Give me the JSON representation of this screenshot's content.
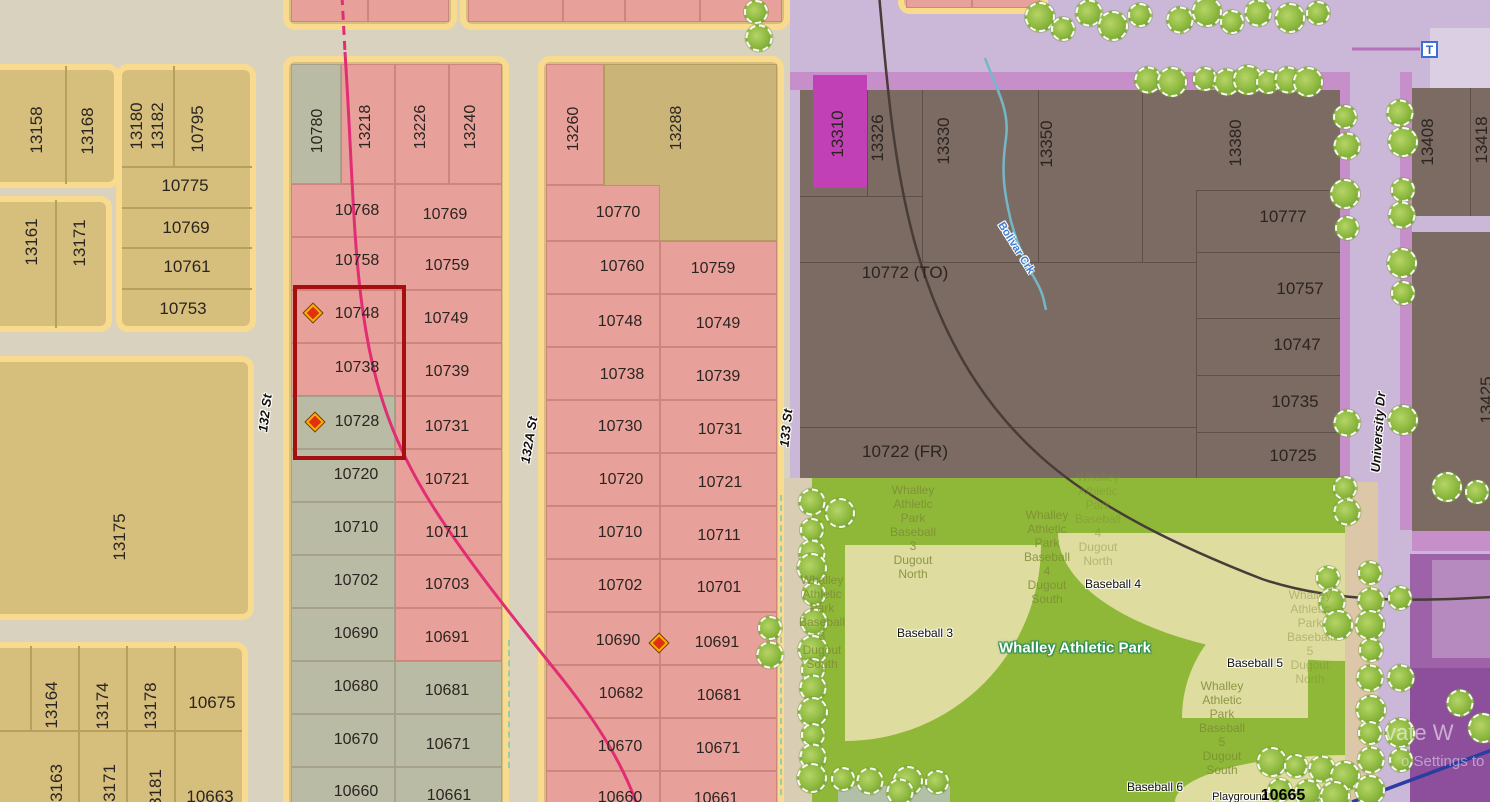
{
  "canvas": {
    "width": 1490,
    "height": 802
  },
  "colors": {
    "selection_red": "#a50f0f",
    "marker_red": "#e03010",
    "marker_ring": "#ffb300",
    "pink_parcel": "#e7a19a",
    "sage_parcel": "#b9bba5",
    "yellow_parcel": "#d6bf7d",
    "yellow_halo": "#f9db8f",
    "khaki_parcel": "#cab477",
    "brown_parcel": "#7b6b63",
    "magenta_parcel": "#c240b5",
    "lavender": "#cbb8d8",
    "purple_road": "#c78fc9",
    "park_green": "#90b838",
    "field_tan": "#dedc9f",
    "magenta_line": "#e12d73",
    "creek_blue": "#74b7c8",
    "dark_line": "#473c37",
    "navy_line": "#2c3da0"
  },
  "streets": [
    {
      "name": "132 St",
      "x": 265,
      "y": 413,
      "rot": -83
    },
    {
      "name": "132A St",
      "x": 529,
      "y": 440,
      "rot": -80
    },
    {
      "name": "133 St",
      "x": 786,
      "y": 428,
      "rot": -84
    },
    {
      "name": "University Dr",
      "x": 1378,
      "y": 432,
      "rot": -86
    }
  ],
  "creek": {
    "name": "Bolivar Crk",
    "x": 1016,
    "y": 248,
    "rot": 58
  },
  "transit": {
    "label": "T",
    "x": 1421,
    "y": 41
  },
  "park": {
    "name": "Whalley Athletic Park",
    "name_x": 1075,
    "name_y": 648,
    "fields": [
      {
        "label": "Baseball 3",
        "x": 925,
        "y": 633
      },
      {
        "label": "Baseball 4",
        "x": 1113,
        "y": 584
      },
      {
        "label": "Baseball 5",
        "x": 1255,
        "y": 663
      },
      {
        "label": "Baseball 6",
        "x": 1155,
        "y": 787
      }
    ],
    "dugout_labels": [
      {
        "lines": [
          "Whalley",
          "Athletic",
          "Park",
          "Baseball",
          "3",
          "Dugout",
          "North"
        ],
        "x": 913,
        "y": 532,
        "faded": false
      },
      {
        "lines": [
          "Whalley",
          "Athletic",
          "Park",
          "Baseball",
          "3",
          "Dugout",
          "South"
        ],
        "x": 822,
        "y": 622,
        "faded": false
      },
      {
        "lines": [
          "Whalley",
          "Athletic",
          "Park",
          "Baseball",
          "4",
          "Dugout",
          "South"
        ],
        "x": 1047,
        "y": 557,
        "faded": false
      },
      {
        "lines": [
          "Whalley",
          "Athletic",
          "Park",
          "Baseball",
          "4",
          "Dugout",
          "North"
        ],
        "x": 1098,
        "y": 519,
        "faded": true
      },
      {
        "lines": [
          "Whalley",
          "Athletic",
          "Park",
          "Baseball",
          "5",
          "Dugout",
          "North"
        ],
        "x": 1310,
        "y": 637,
        "faded": true
      },
      {
        "lines": [
          "Whalley",
          "Athletic",
          "Park",
          "Baseball",
          "5",
          "Dugout",
          "South"
        ],
        "x": 1222,
        "y": 728,
        "faded": false
      }
    ],
    "playground": {
      "label": "Playground",
      "x": 1240,
      "y": 797
    },
    "lot": {
      "label": "10665",
      "x": 1283,
      "y": 796
    }
  },
  "watermark": {
    "line1": "vate W",
    "line2": "o Settings to"
  },
  "selection": {
    "parcels": [
      "10748",
      "10738",
      "10728"
    ],
    "rect": {
      "x": 293,
      "y": 285,
      "w": 105,
      "h": 167
    }
  },
  "markers": [
    {
      "x": 313,
      "y": 313
    },
    {
      "x": 315,
      "y": 422
    },
    {
      "x": 659,
      "y": 643
    }
  ],
  "parcel_labels": [
    {
      "t": "13158",
      "x": 37,
      "y": 130,
      "v": 1,
      "b": 1
    },
    {
      "t": "13168",
      "x": 88,
      "y": 131,
      "v": 1,
      "b": 1
    },
    {
      "t": "13180",
      "x": 137,
      "y": 126,
      "v": 1,
      "b": 1
    },
    {
      "t": "13182",
      "x": 158,
      "y": 126,
      "v": 1,
      "b": 1
    },
    {
      "t": "10795",
      "x": 198,
      "y": 129,
      "v": 1,
      "b": 1
    },
    {
      "t": "10775",
      "x": 185,
      "y": 186,
      "b": 1
    },
    {
      "t": "10769",
      "x": 186,
      "y": 228,
      "b": 1
    },
    {
      "t": "10761",
      "x": 187,
      "y": 267,
      "b": 1
    },
    {
      "t": "10753",
      "x": 183,
      "y": 309,
      "b": 1
    },
    {
      "t": "13161",
      "x": 32,
      "y": 242,
      "v": 1,
      "b": 1
    },
    {
      "t": "13171",
      "x": 80,
      "y": 243,
      "v": 1,
      "b": 1
    },
    {
      "t": "13175",
      "x": 120,
      "y": 537,
      "v": 1,
      "b": 1
    },
    {
      "t": "13164",
      "x": 52,
      "y": 705,
      "v": 1,
      "b": 1
    },
    {
      "t": "13174",
      "x": 103,
      "y": 706,
      "v": 1,
      "b": 1
    },
    {
      "t": "13178",
      "x": 151,
      "y": 706,
      "v": 1,
      "b": 1
    },
    {
      "t": "10675",
      "x": 212,
      "y": 703,
      "b": 1
    },
    {
      "t": "3163",
      "x": 57,
      "y": 783,
      "v": 1,
      "b": 1
    },
    {
      "t": "3171",
      "x": 110,
      "y": 783,
      "v": 1,
      "b": 1
    },
    {
      "t": "3181",
      "x": 156,
      "y": 788,
      "v": 1,
      "b": 1
    },
    {
      "t": "10663",
      "x": 210,
      "y": 797,
      "b": 1
    },
    {
      "t": "10780",
      "x": 318,
      "y": 131,
      "v": 1
    },
    {
      "t": "13218",
      "x": 366,
      "y": 127,
      "v": 1
    },
    {
      "t": "13226",
      "x": 421,
      "y": 127,
      "v": 1
    },
    {
      "t": "13240",
      "x": 471,
      "y": 127,
      "v": 1
    },
    {
      "t": "10768",
      "x": 357,
      "y": 211
    },
    {
      "t": "10769",
      "x": 445,
      "y": 215
    },
    {
      "t": "10758",
      "x": 357,
      "y": 261
    },
    {
      "t": "10759",
      "x": 447,
      "y": 266
    },
    {
      "t": "10748",
      "x": 357,
      "y": 314
    },
    {
      "t": "10749",
      "x": 446,
      "y": 319
    },
    {
      "t": "10738",
      "x": 357,
      "y": 368
    },
    {
      "t": "10739",
      "x": 447,
      "y": 372
    },
    {
      "t": "10728",
      "x": 357,
      "y": 422
    },
    {
      "t": "10731",
      "x": 447,
      "y": 427
    },
    {
      "t": "10720",
      "x": 356,
      "y": 475
    },
    {
      "t": "10721",
      "x": 447,
      "y": 480
    },
    {
      "t": "10710",
      "x": 356,
      "y": 528
    },
    {
      "t": "10711",
      "x": 447,
      "y": 533
    },
    {
      "t": "10702",
      "x": 356,
      "y": 581
    },
    {
      "t": "10703",
      "x": 447,
      "y": 585
    },
    {
      "t": "10690",
      "x": 356,
      "y": 634
    },
    {
      "t": "10691",
      "x": 447,
      "y": 638
    },
    {
      "t": "10680",
      "x": 356,
      "y": 687
    },
    {
      "t": "10681",
      "x": 447,
      "y": 691
    },
    {
      "t": "10670",
      "x": 356,
      "y": 740
    },
    {
      "t": "10671",
      "x": 448,
      "y": 745
    },
    {
      "t": "10660",
      "x": 356,
      "y": 792
    },
    {
      "t": "10661",
      "x": 449,
      "y": 796
    },
    {
      "t": "13260",
      "x": 574,
      "y": 129,
      "v": 1
    },
    {
      "t": "13288",
      "x": 677,
      "y": 128,
      "v": 1
    },
    {
      "t": "10770",
      "x": 618,
      "y": 213
    },
    {
      "t": "10760",
      "x": 622,
      "y": 267
    },
    {
      "t": "10759",
      "x": 713,
      "y": 269
    },
    {
      "t": "10748",
      "x": 620,
      "y": 322
    },
    {
      "t": "10749",
      "x": 718,
      "y": 324
    },
    {
      "t": "10738",
      "x": 622,
      "y": 375
    },
    {
      "t": "10739",
      "x": 718,
      "y": 377
    },
    {
      "t": "10730",
      "x": 620,
      "y": 427
    },
    {
      "t": "10731",
      "x": 720,
      "y": 430
    },
    {
      "t": "10720",
      "x": 621,
      "y": 480
    },
    {
      "t": "10721",
      "x": 720,
      "y": 483
    },
    {
      "t": "10710",
      "x": 620,
      "y": 533
    },
    {
      "t": "10711",
      "x": 719,
      "y": 536
    },
    {
      "t": "10702",
      "x": 620,
      "y": 586
    },
    {
      "t": "10701",
      "x": 719,
      "y": 588
    },
    {
      "t": "10690",
      "x": 618,
      "y": 641
    },
    {
      "t": "10691",
      "x": 717,
      "y": 643
    },
    {
      "t": "10682",
      "x": 621,
      "y": 694
    },
    {
      "t": "10681",
      "x": 719,
      "y": 696
    },
    {
      "t": "10670",
      "x": 620,
      "y": 747
    },
    {
      "t": "10671",
      "x": 718,
      "y": 749
    },
    {
      "t": "10660",
      "x": 620,
      "y": 798
    },
    {
      "t": "10661",
      "x": 716,
      "y": 799
    },
    {
      "t": "13310",
      "x": 838,
      "y": 134,
      "v": 1,
      "b": 1
    },
    {
      "t": "13326",
      "x": 878,
      "y": 138,
      "v": 1,
      "b": 1
    },
    {
      "t": "13330",
      "x": 944,
      "y": 141,
      "v": 1,
      "b": 1
    },
    {
      "t": "13350",
      "x": 1047,
      "y": 144,
      "v": 1,
      "b": 1
    },
    {
      "t": "13380",
      "x": 1236,
      "y": 143,
      "v": 1,
      "b": 1
    },
    {
      "t": "10777",
      "x": 1283,
      "y": 217,
      "b": 1
    },
    {
      "t": "10772 (TO)",
      "x": 905,
      "y": 273,
      "b": 1
    },
    {
      "t": "10757",
      "x": 1300,
      "y": 289,
      "b": 1
    },
    {
      "t": "10747",
      "x": 1297,
      "y": 345,
      "b": 1
    },
    {
      "t": "10735",
      "x": 1295,
      "y": 402,
      "b": 1
    },
    {
      "t": "10725",
      "x": 1293,
      "y": 456,
      "b": 1
    },
    {
      "t": "10722 (FR)",
      "x": 905,
      "y": 452,
      "b": 1
    },
    {
      "t": "13408",
      "x": 1428,
      "y": 142,
      "v": 1,
      "b": 1
    },
    {
      "t": "13418",
      "x": 1482,
      "y": 140,
      "v": 1,
      "b": 1
    },
    {
      "t": "13425",
      "x": 1487,
      "y": 400,
      "v": 1,
      "b": 1
    }
  ]
}
